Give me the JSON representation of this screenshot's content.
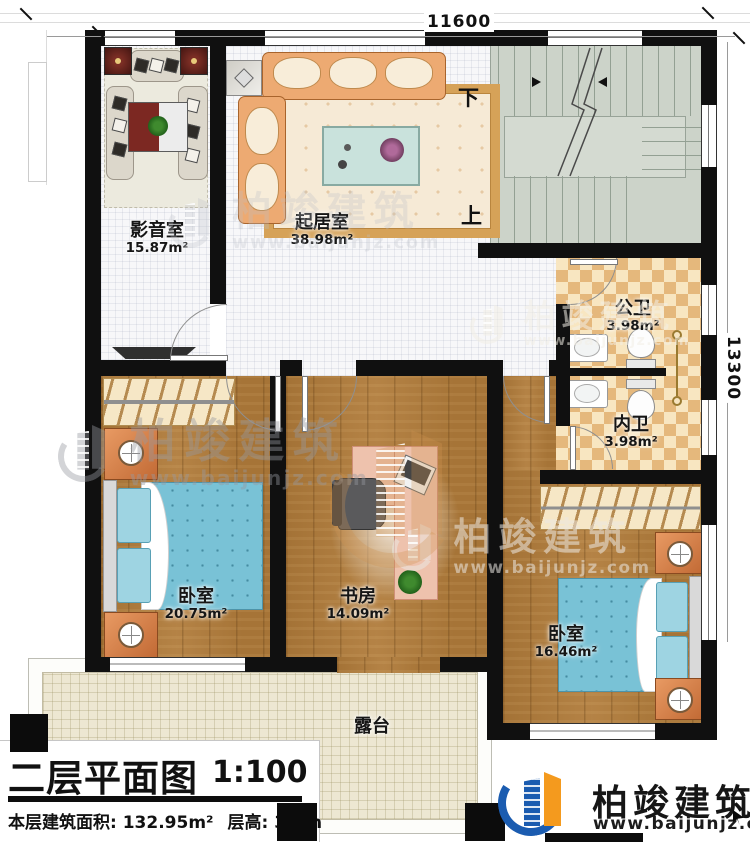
{
  "plan": {
    "dim_top": "11600",
    "dim_right": "13300",
    "stair_down": "下",
    "stair_up": "上"
  },
  "rooms": [
    {
      "name": "影音室",
      "area": "15.87m²"
    },
    {
      "name": "起居室",
      "area": "38.98m²"
    },
    {
      "name": "公卫",
      "area": "3.98m²"
    },
    {
      "name": "内卫",
      "area": "3.98m²"
    },
    {
      "name": "卧室",
      "area": "20.75m²"
    },
    {
      "name": "书房",
      "area": "14.09m²"
    },
    {
      "name": "卧室",
      "area": "16.46m²"
    },
    {
      "name": "露台",
      "area": ""
    }
  ],
  "title_block": {
    "title": "二层平面图",
    "scale": "1:100",
    "area_label": "本层建筑面积: 132.95m²",
    "height_label": "层高: 3.3m"
  },
  "brand": {
    "name": "柏竣建筑",
    "site": "www.baijunjz.com",
    "blue": "#1b5cb0",
    "orange": "#f49a1e"
  },
  "watermark": {
    "name": "柏竣建筑",
    "site": "www.baijunjz.com"
  }
}
